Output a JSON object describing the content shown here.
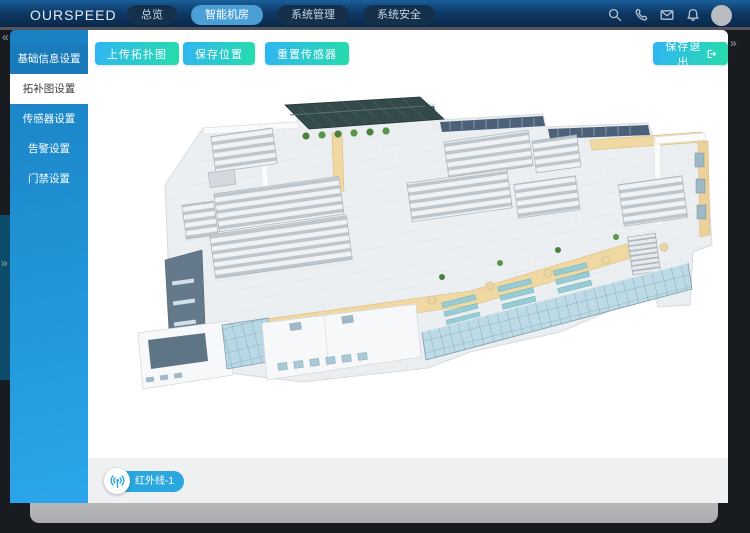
{
  "navbar": {
    "logo": "OURSPEED",
    "tabs": [
      {
        "label": "总览",
        "active": false
      },
      {
        "label": "智能机房",
        "active": true
      },
      {
        "label": "系统管理",
        "active": false
      },
      {
        "label": "系统安全",
        "active": false
      }
    ],
    "icons": [
      "search-icon",
      "phone-icon",
      "mail-icon",
      "bell-icon"
    ]
  },
  "sidebar": {
    "items": [
      {
        "label": "基础信息设置",
        "active": false
      },
      {
        "label": "拓补图设置",
        "active": true
      },
      {
        "label": "传感器设置",
        "active": false
      },
      {
        "label": "告警设置",
        "active": false
      },
      {
        "label": "门禁设置",
        "active": false
      }
    ]
  },
  "toolbar": {
    "upload": "上传拓扑图",
    "save_position": "保存位置",
    "reset_sensor": "重置传感器",
    "save_exit": "保存退出"
  },
  "sensor_badge": {
    "label": "红外线-1",
    "icon": "signal-icon"
  },
  "chevrons": {
    "collapse_left": "«",
    "expand_mid": "»",
    "expand_right": "»"
  },
  "colors": {
    "accent_gradient_start": "#2fb6f2",
    "accent_gradient_end": "#27dcab",
    "sidebar_blue": "#2196d8",
    "navbar_navy": "#0d3a68",
    "active_tab_blue": "#4aa0d6",
    "badge_blue": "#2aa7de",
    "floor_gray": "#eceff1",
    "wall_yellow": "#f0d8a2",
    "glass_blue": "#b9d8e6",
    "atrium_glass_dark": "#33494a",
    "rack_light": "#f0f2f4",
    "rack_dark": "#bdc6cd"
  },
  "floorplan": {
    "kind": "isometric 3D data-center floor plan"
  }
}
